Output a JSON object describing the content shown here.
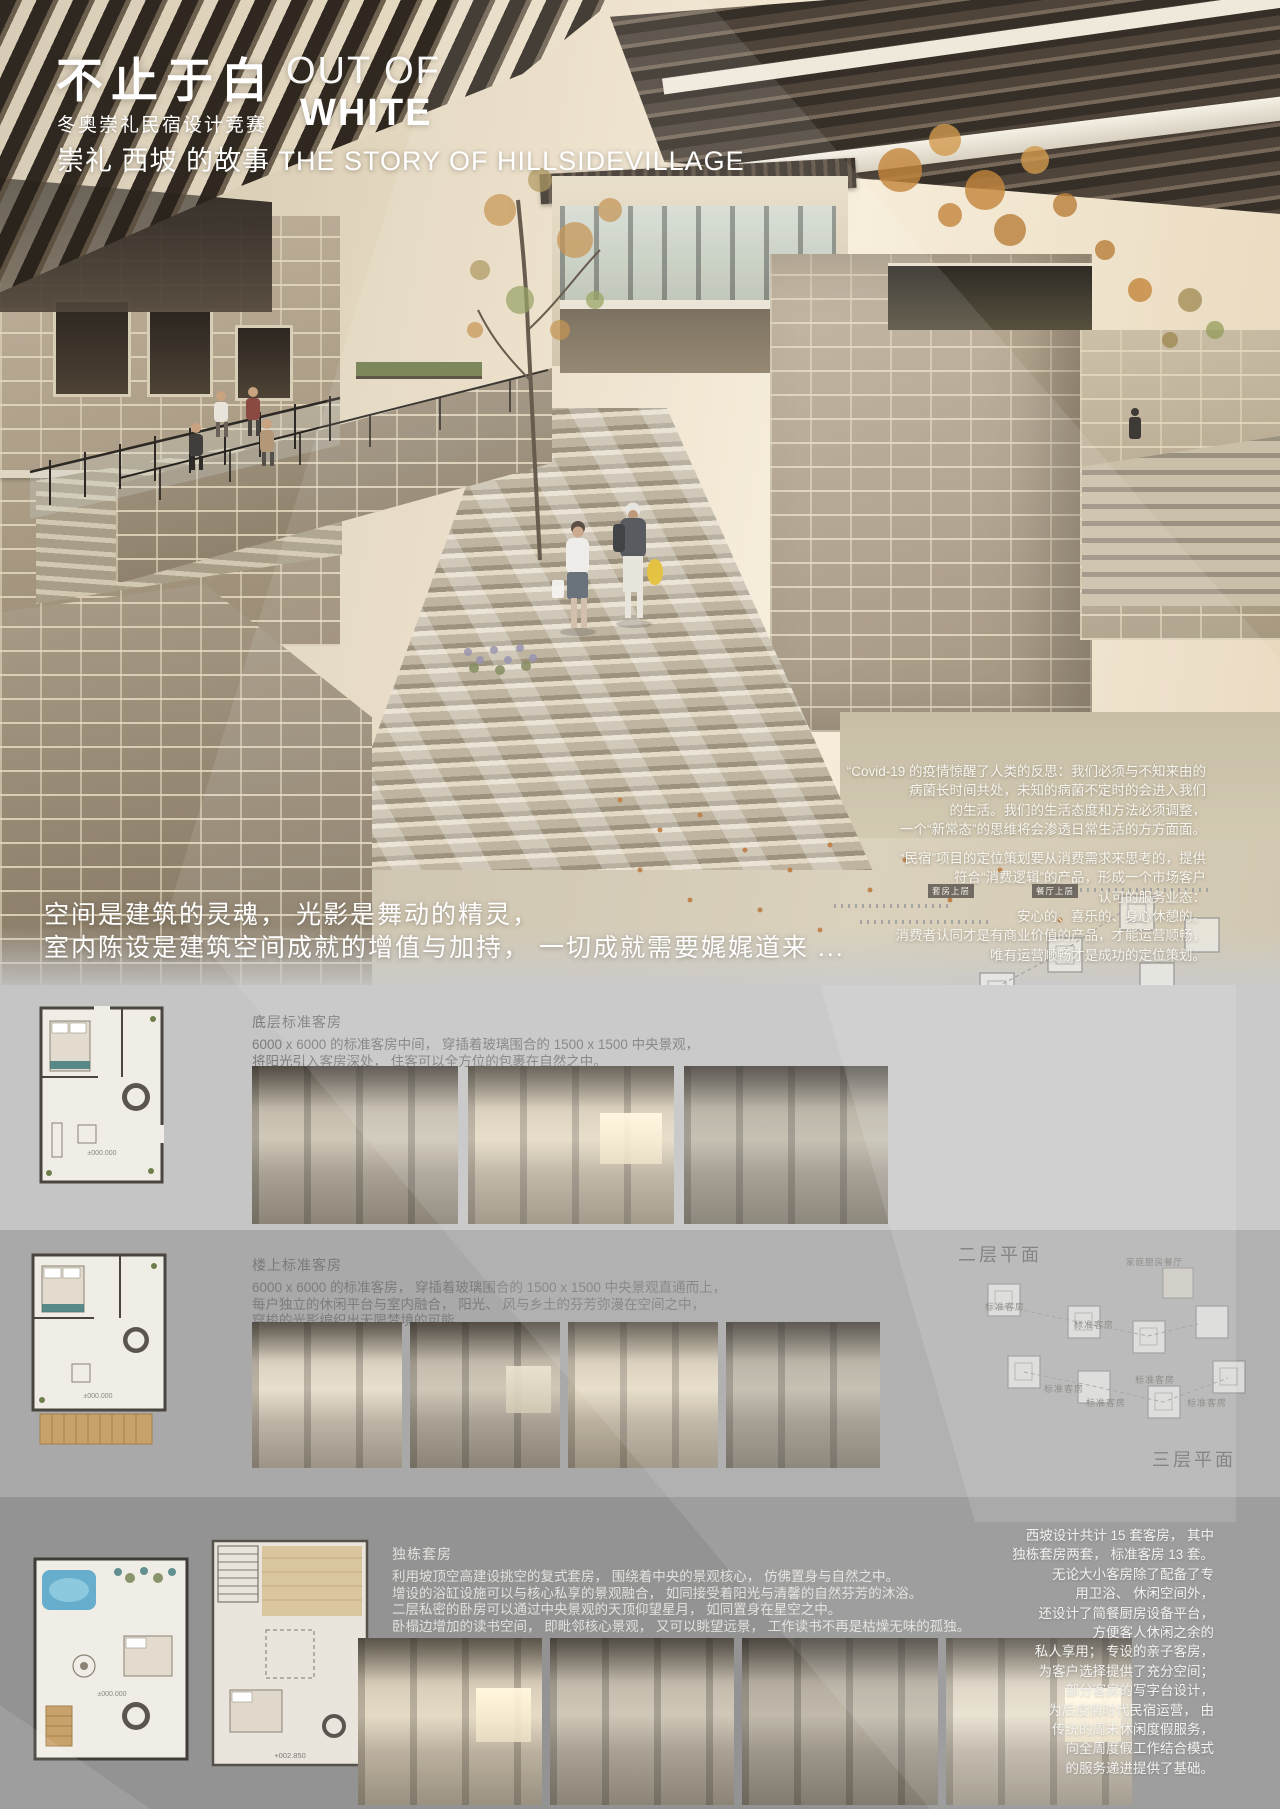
{
  "header": {
    "title_cn": "不止于白",
    "title_en_line1": "OUT OF",
    "title_en_line2": "WHITE",
    "subtitle": "冬奥崇礼民宿设计竞赛",
    "story": "崇礼 西坡 的故事  THE STORY OF HILLSIDEVILLAGE"
  },
  "intro": {
    "para1": [
      "“Covid-19 的疫情惊醒了人类的反思：我们必须与不知来由的",
      "病菌长时间共处，未知的病菌不定时的会进入我们",
      "的生活。我们的生活态度和方法必须调整，",
      "一个“新常态”的思维将会渗透日常生活的方方面面。"
    ],
    "para2": [
      "“民宿”项目的定位策划要从消费需求来思考的，提供",
      "符合“消费逻辑”的产品，形成一个市场客户",
      "认可的服务业态：",
      "安心的、喜乐的、身心休憩的。",
      "消费者认同才是有商业价值的产品，才能运营顺畅，",
      "唯有运营顺畅才是成功的定位策划。"
    ]
  },
  "slogan": {
    "line1": "空间是建筑的灵魂， 光影是舞动的精灵，",
    "line2": "室内陈设是建筑空间成就的增值与加持， 一切成就需要娓娓道来 ..."
  },
  "sections": [
    {
      "title": "底层标准客房",
      "lines": [
        "6000 x 6000 的标准客房中间， 穿插着玻璃围合的 1500 x 1500 中央景观，",
        "将阳光引入客房深处， 住客可以全方位的包裹在自然之中。"
      ]
    },
    {
      "title": "楼上标准客房",
      "lines": [
        "6000 x 6000 的标准客房， 穿插着玻璃围合的 1500 x 1500 中央景观直通而上，",
        "每户独立的休闲平台与室内融合， 阳光、 风与乡土的芬芳弥漫在空间之中，",
        "穿梭的光影编织出无限梦境的可能。"
      ]
    },
    {
      "title": "独栋套房",
      "lines": [
        "利用坡顶空高建设挑空的复式套房， 围绕着中央的景观核心， 仿佛置身与自然之中。",
        "增设的浴缸设施可以与核心私享的景观融合， 如同接受着阳光与清馨的自然芬芳的沐浴。",
        "二层私密的卧房可以通过中央景观的天顶仰望星月， 如同置身在星空之中。",
        "卧榻边增加的读书空间， 即毗邻核心景观， 又可以眺望远景， 工作读书不再是枯燥无味的孤独。"
      ]
    }
  ],
  "plans": {
    "ground_level": "±000.000",
    "upper_level": "±000.000",
    "suite_level": "±000.000",
    "suite_upper_level": "+002.850"
  },
  "site_plans": {
    "level1": {
      "label": "一层平面",
      "tags": {
        "suite_upper": "套房上层",
        "dining_upper": "餐厅上层",
        "shared_corridor": "共享长廊",
        "lobby": "迎宾大厅",
        "double_kitchen": "双层厨房餐厅",
        "public_lounge": "公共客厅",
        "guest_room": "客房",
        "std_a": "标准客房",
        "std_b": "标准客房",
        "std_c": "标准客房"
      }
    },
    "level2": {
      "label": "二层平面",
      "tags": {
        "family_kitchen": "家庭厨房餐厅",
        "std_a": "标准客房",
        "std_b": "标准客房",
        "std_c": "标准客房",
        "std_d": "标准客房",
        "std_e": "标准客房",
        "std_f": "标准客房"
      }
    },
    "level3": {
      "label": "三层平面"
    }
  },
  "closing": {
    "lines": [
      "西坡设计共计 15 套客房， 其中",
      "独栋套房两套， 标准客房 13 套。",
      "无论大小客房除了配备了专",
      "用卫浴、 休闲空间外，",
      "还设计了简餐厨房设备平台，",
      "方便客人休闲之余的",
      "私人享用； 专设的亲子客房，",
      "为客户选择提供了充分空间；",
      "部分客房的写字台设计，",
      "为后疫情时代民宿运营， 由",
      "传统的周末休闲度假服务，",
      "向全周度假工作结合模式",
      "的服务递进提供了基础。"
    ]
  },
  "colors": {
    "band1": "#c5c5c5",
    "band2": "#a9a9a9",
    "band3": "#939393",
    "accent_teal": "#3e7a7c",
    "pool_blue": "#66aecb",
    "bag_yellow": "#e2bd2d",
    "title_white": "#ffffff"
  }
}
